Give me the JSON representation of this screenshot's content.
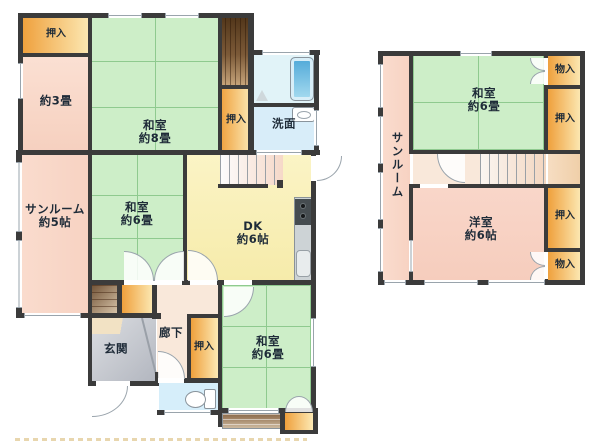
{
  "floor1": {
    "closet_top_left": "押入",
    "room_3jo": "約3畳",
    "washitsu_8": "和室\n約8畳",
    "closet_mid": "押入",
    "washroom": "洗面",
    "sunroom": "サンルーム\n約5帖",
    "washitsu_6_center": "和室\n約6畳",
    "dk": "DK\n約6帖",
    "hallway": "廊下",
    "entrance": "玄関",
    "closet_hall": "押入",
    "washitsu_6_south": "和室\n約6畳"
  },
  "floor2": {
    "storage_top": "物入",
    "washitsu_6": "和室\n約6畳",
    "closet_top": "押入",
    "sunroom": "サンルーム",
    "youshitsu_6": "洋室\n約6帖",
    "closet_bottom": "押入",
    "storage_bottom": "物入"
  },
  "colors": {
    "wall": "#3b3b3b",
    "tatami_green": "#cdeec8",
    "tatami_line": "#8fca8f",
    "pink_room": "#f8d8c9",
    "dk_yellow": "#f9f0b8",
    "closet_orange": "#efa03c",
    "bath_blue": "#e1f3f8",
    "tub_blue": "#5cb4e4",
    "entrance_gray": "#c6c9cf",
    "stair_wood": "#6b4a2e",
    "veranda_brown": "#9a7a58",
    "hall_peach": "#f9e8da",
    "label_text": "#1e2b38"
  }
}
